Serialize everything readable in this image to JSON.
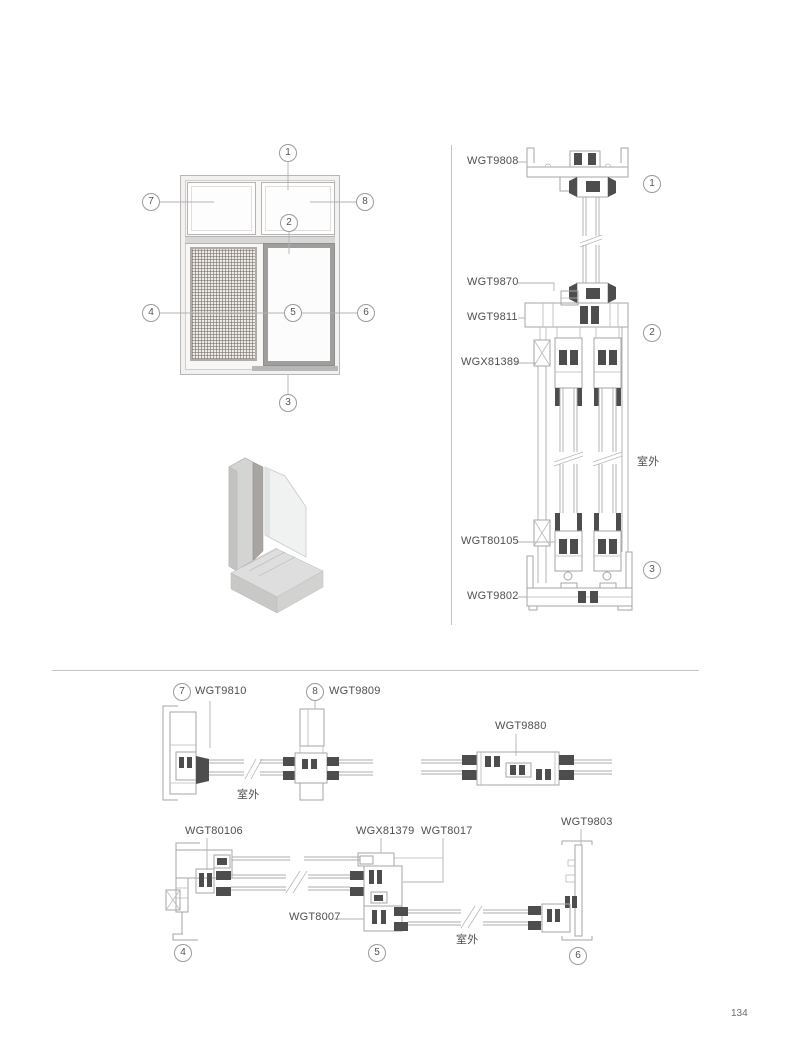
{
  "page": {
    "number": "134"
  },
  "elevation": {
    "callouts": {
      "c1": "1",
      "c2": "2",
      "c3": "3",
      "c4": "4",
      "c5": "5",
      "c6": "6",
      "c7": "7",
      "c8": "8"
    }
  },
  "vertical_section": {
    "label_head": "WGT9808",
    "label_transom_sash": "WGT9870",
    "label_transom": "WGT9811",
    "label_screen_track": "WGX81389",
    "label_interlock": "WGT80105",
    "label_sill": "WGT9802",
    "callout_head": "1",
    "callout_transom": "2",
    "callout_sill": "3",
    "outdoor": "室外"
  },
  "row1": {
    "callout_left": "7",
    "label_left": "WGT9810",
    "callout_right": "8",
    "label_right": "WGT9809",
    "label_center": "WGT9880",
    "outdoor": "室外"
  },
  "row2": {
    "label_left_jamb": "WGT80106",
    "label_interlock": "WGX81379",
    "label_sash": "WGT8017",
    "label_right_jamb": "WGT9803",
    "label_adapter": "WGT8007",
    "callout_left": "4",
    "callout_center": "5",
    "callout_right": "6",
    "outdoor": "室外"
  }
}
